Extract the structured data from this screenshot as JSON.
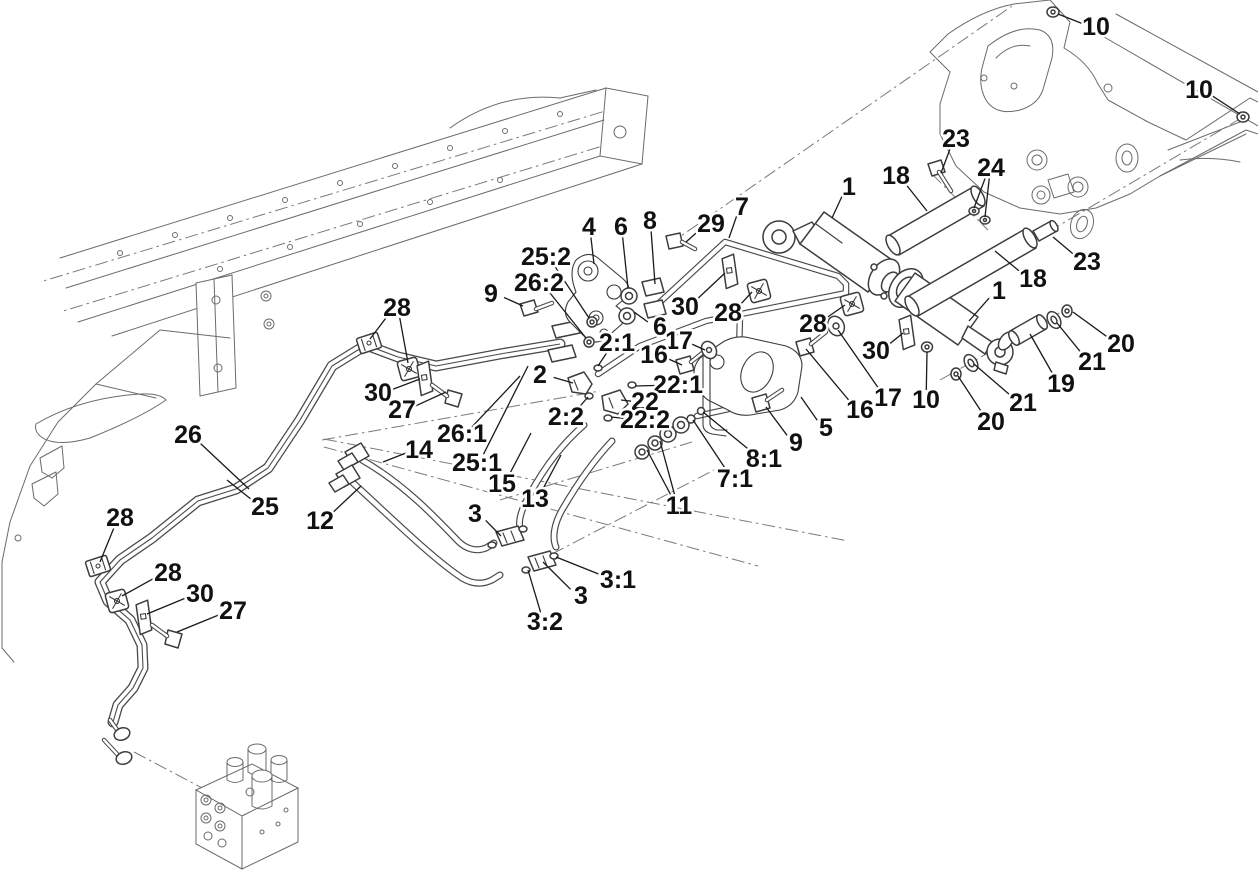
{
  "figure": {
    "width": 1258,
    "height": 871,
    "background": "#ffffff",
    "line_color": "#4a4a4a",
    "thin_line_color": "#6b6b6b",
    "label_color": "#111111",
    "leader_color": "#1a1a1a",
    "label_font_size": 25
  },
  "callouts": [
    {
      "label": "10",
      "x": 1096,
      "y": 27,
      "t": [
        [
          1058,
          14
        ]
      ]
    },
    {
      "label": "10",
      "x": 1199,
      "y": 90,
      "t": [
        [
          1240,
          114
        ]
      ]
    },
    {
      "label": "23",
      "x": 956,
      "y": 139,
      "t": [
        [
          941,
          173
        ]
      ]
    },
    {
      "label": "24",
      "x": 991,
      "y": 168,
      "t": [
        [
          974,
          208
        ],
        [
          985,
          217
        ]
      ]
    },
    {
      "label": "18",
      "x": 896,
      "y": 176,
      "t": [
        [
          927,
          211
        ]
      ]
    },
    {
      "label": "1",
      "x": 849,
      "y": 187,
      "t": [
        [
          832,
          218
        ]
      ]
    },
    {
      "label": "23",
      "x": 1087,
      "y": 262,
      "t": [
        [
          1053,
          237
        ]
      ]
    },
    {
      "label": "18",
      "x": 1033,
      "y": 279,
      "t": [
        [
          995,
          251
        ]
      ]
    },
    {
      "label": "1",
      "x": 999,
      "y": 291,
      "t": [
        [
          969,
          321
        ]
      ]
    },
    {
      "label": "20",
      "x": 1121,
      "y": 344,
      "t": [
        [
          1073,
          312
        ]
      ]
    },
    {
      "label": "21",
      "x": 1092,
      "y": 362,
      "t": [
        [
          1057,
          323
        ]
      ]
    },
    {
      "label": "19",
      "x": 1061,
      "y": 384,
      "t": [
        [
          1030,
          334
        ]
      ]
    },
    {
      "label": "21",
      "x": 1023,
      "y": 403,
      "t": [
        [
          974,
          364
        ]
      ]
    },
    {
      "label": "20",
      "x": 991,
      "y": 422,
      "t": [
        [
          958,
          376
        ]
      ]
    },
    {
      "label": "10",
      "x": 926,
      "y": 400,
      "t": [
        [
          927,
          352
        ]
      ]
    },
    {
      "label": "17",
      "x": 888,
      "y": 398,
      "t": [
        [
          838,
          330
        ]
      ]
    },
    {
      "label": "16",
      "x": 860,
      "y": 410,
      "t": [
        [
          806,
          349
        ]
      ]
    },
    {
      "label": "30",
      "x": 876,
      "y": 351,
      "t": [
        [
          903,
          333
        ]
      ]
    },
    {
      "label": "28",
      "x": 813,
      "y": 324,
      "t": [
        [
          845,
          305
        ]
      ]
    },
    {
      "label": "5",
      "x": 826,
      "y": 428,
      "t": [
        [
          801,
          397
        ]
      ]
    },
    {
      "label": "9",
      "x": 796,
      "y": 443,
      "t": [
        [
          766,
          407
        ]
      ]
    },
    {
      "label": "8:1",
      "x": 764,
      "y": 459,
      "t": [
        [
          703,
          412
        ]
      ]
    },
    {
      "label": "7:1",
      "x": 735,
      "y": 479,
      "t": [
        [
          693,
          420
        ]
      ]
    },
    {
      "label": "11",
      "x": 679,
      "y": 506,
      "t": [
        [
          647,
          450
        ],
        [
          660,
          441
        ]
      ]
    },
    {
      "label": "9",
      "x": 491,
      "y": 294,
      "t": [
        [
          523,
          306
        ]
      ]
    },
    {
      "label": "25:2",
      "x": 546,
      "y": 257,
      "t": [
        [
          589,
          318
        ]
      ]
    },
    {
      "label": "26:2",
      "x": 539,
      "y": 283,
      "t": [
        [
          586,
          338
        ]
      ]
    },
    {
      "label": "4",
      "x": 589,
      "y": 227,
      "t": [
        [
          594,
          264
        ]
      ]
    },
    {
      "label": "6",
      "x": 621,
      "y": 227,
      "t": [
        [
          628,
          288
        ]
      ]
    },
    {
      "label": "8",
      "x": 650,
      "y": 221,
      "t": [
        [
          655,
          284
        ]
      ]
    },
    {
      "label": "29",
      "x": 711,
      "y": 224,
      "t": [
        [
          686,
          242
        ]
      ]
    },
    {
      "label": "7",
      "x": 742,
      "y": 207,
      "t": [
        [
          729,
          238
        ]
      ]
    },
    {
      "label": "30",
      "x": 685,
      "y": 307,
      "t": [
        [
          725,
          273
        ]
      ]
    },
    {
      "label": "28",
      "x": 728,
      "y": 313,
      "t": [
        [
          752,
          292
        ]
      ]
    },
    {
      "label": "6",
      "x": 660,
      "y": 327,
      "t": [
        [
          634,
          312
        ]
      ]
    },
    {
      "label": "17",
      "x": 679,
      "y": 341,
      "t": [
        [
          705,
          350
        ]
      ]
    },
    {
      "label": "16",
      "x": 654,
      "y": 355,
      "t": [
        [
          682,
          365
        ]
      ]
    },
    {
      "label": "2:1",
      "x": 617,
      "y": 343,
      "t": [
        [
          598,
          366
        ]
      ]
    },
    {
      "label": "2",
      "x": 540,
      "y": 375,
      "t": [
        [
          573,
          383
        ]
      ]
    },
    {
      "label": "22:1",
      "x": 678,
      "y": 385,
      "t": [
        [
          635,
          386
        ]
      ]
    },
    {
      "label": "22",
      "x": 645,
      "y": 402,
      "t": [
        [
          621,
          400
        ]
      ]
    },
    {
      "label": "2:2",
      "x": 566,
      "y": 417,
      "t": [
        [
          588,
          397
        ]
      ]
    },
    {
      "label": "22:2",
      "x": 645,
      "y": 420,
      "t": [
        [
          611,
          417
        ]
      ]
    },
    {
      "label": "28",
      "x": 397,
      "y": 308,
      "t": [
        [
          370,
          339
        ],
        [
          408,
          363
        ]
      ]
    },
    {
      "label": "30",
      "x": 378,
      "y": 393,
      "t": [
        [
          420,
          379
        ]
      ]
    },
    {
      "label": "27",
      "x": 402,
      "y": 410,
      "t": [
        [
          446,
          392
        ]
      ]
    },
    {
      "label": "26:1",
      "x": 462,
      "y": 434,
      "t": [
        [
          520,
          376
        ]
      ]
    },
    {
      "label": "25:1",
      "x": 477,
      "y": 463,
      "t": [
        [
          528,
          366
        ]
      ]
    },
    {
      "label": "15",
      "x": 502,
      "y": 484,
      "t": [
        [
          531,
          433
        ]
      ]
    },
    {
      "label": "13",
      "x": 535,
      "y": 499,
      "t": [
        [
          561,
          455
        ]
      ]
    },
    {
      "label": "14",
      "x": 419,
      "y": 450,
      "t": [
        [
          383,
          462
        ]
      ]
    },
    {
      "label": "12",
      "x": 320,
      "y": 521,
      "t": [
        [
          361,
          486
        ]
      ]
    },
    {
      "label": "26",
      "x": 188,
      "y": 435,
      "t": [
        [
          249,
          489
        ]
      ]
    },
    {
      "label": "25",
      "x": 265,
      "y": 507,
      "t": [
        [
          227,
          480
        ]
      ]
    },
    {
      "label": "28",
      "x": 120,
      "y": 518,
      "t": [
        [
          100,
          562
        ]
      ]
    },
    {
      "label": "28",
      "x": 168,
      "y": 573,
      "t": [
        [
          122,
          596
        ]
      ]
    },
    {
      "label": "30",
      "x": 200,
      "y": 594,
      "t": [
        [
          147,
          614
        ]
      ]
    },
    {
      "label": "27",
      "x": 233,
      "y": 611,
      "t": [
        [
          177,
          632
        ]
      ]
    },
    {
      "label": "3",
      "x": 475,
      "y": 514,
      "t": [
        [
          501,
          536
        ]
      ]
    },
    {
      "label": "3:1",
      "x": 618,
      "y": 580,
      "t": [
        [
          556,
          557
        ]
      ]
    },
    {
      "label": "3",
      "x": 581,
      "y": 596,
      "t": [
        [
          543,
          562
        ]
      ]
    },
    {
      "label": "3:2",
      "x": 545,
      "y": 622,
      "t": [
        [
          528,
          570
        ]
      ]
    }
  ]
}
